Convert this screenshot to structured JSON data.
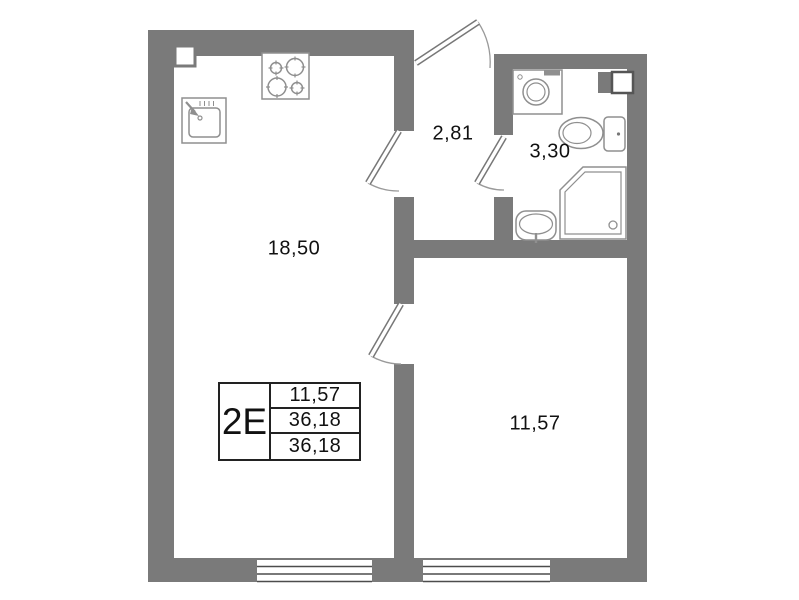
{
  "plan_title": "apartment-floor-plan",
  "rooms": {
    "kitchen_living": {
      "area": "18,50"
    },
    "hallway": {
      "area": "2,81"
    },
    "bathroom": {
      "area": "3,30"
    },
    "room": {
      "area": "11,57"
    }
  },
  "info_table": {
    "type": "2E",
    "values": [
      "11,57",
      "36,18",
      "36,18"
    ]
  },
  "fixtures": [
    "stove-icon",
    "kitchen-sink-icon",
    "vent-pillar-icon",
    "washing-machine-icon",
    "vent-shaft-icon",
    "toilet-icon",
    "shower-icon",
    "bathroom-sink-icon"
  ],
  "openings": [
    "entry-door",
    "kitchen-hall-door",
    "bathroom-door",
    "room-door",
    "window-living",
    "window-room"
  ],
  "colors": {
    "wall": "#7a7a7a",
    "fixture_outline": "#8f8f8f",
    "door_outline": "#777777",
    "window_line": "#4d4d4d",
    "text": "#111111",
    "table_border": "#222222",
    "background": "#ffffff"
  }
}
